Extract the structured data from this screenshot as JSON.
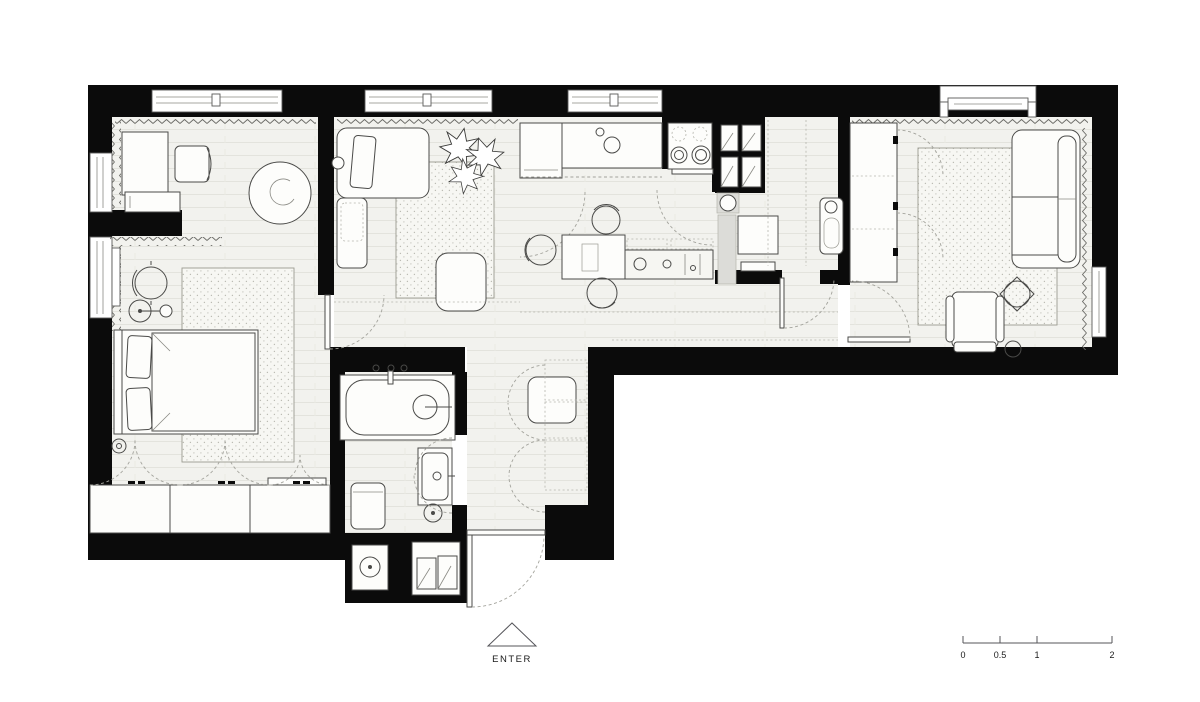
{
  "labels": {
    "enter": "ENTER"
  },
  "scale_bar": {
    "labels": [
      "0",
      "0.5",
      "1",
      "2"
    ]
  },
  "colors": {
    "wall": "#0b0b0b",
    "floor_base": "#f2f2ee",
    "floor_line": "#e3e3dd",
    "rug_base": "#f7f7f3",
    "rug_dot": "#b9b9b1",
    "furniture_stroke": "#4a4a48",
    "furniture_fill": "#fdfdfb",
    "dashed_line": "#a3a39c",
    "gray_fill": "#dcdcd8",
    "background": "#ffffff"
  }
}
